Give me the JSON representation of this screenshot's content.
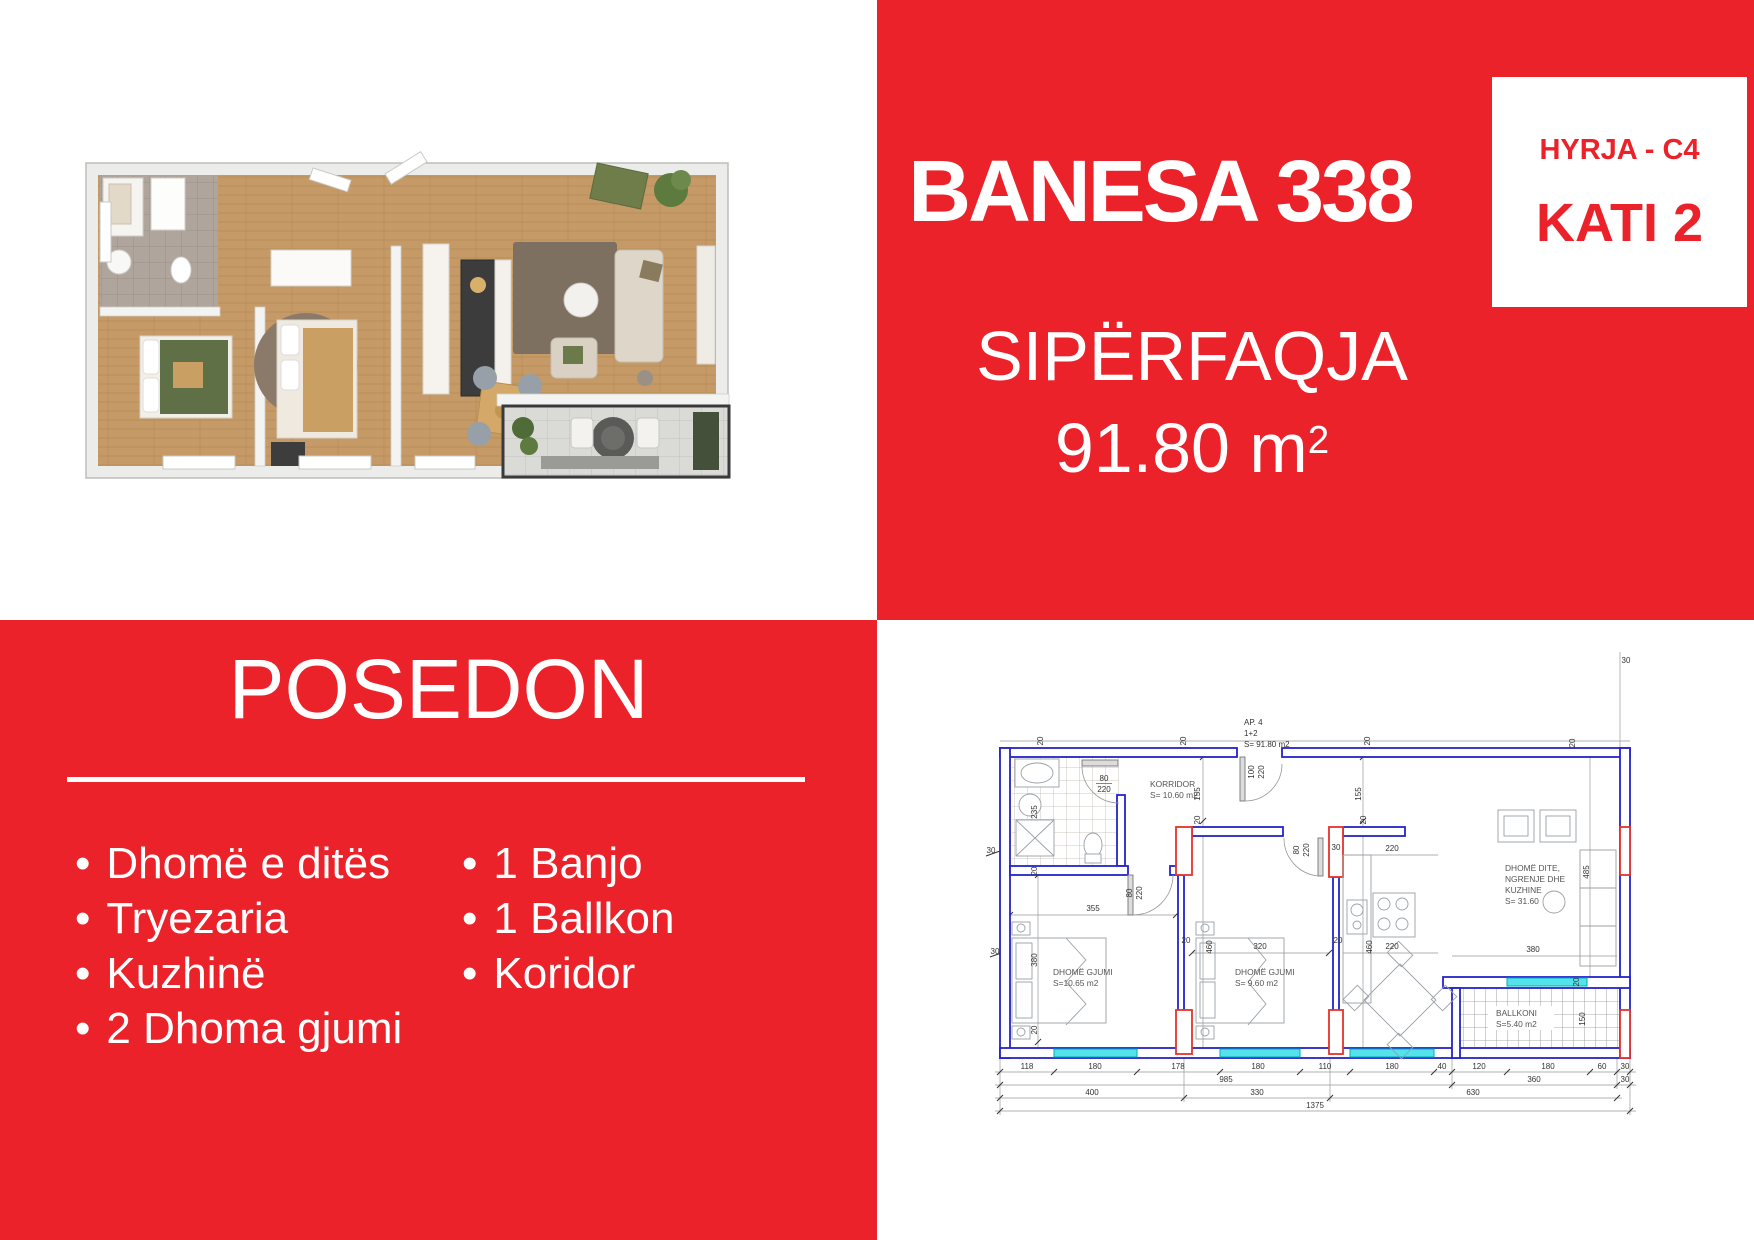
{
  "colors": {
    "brand_red": "#EB222A",
    "plan_wall_blue": "#2323CE",
    "plan_accent_red": "#E53228",
    "plan_window_cyan": "#55E2EA"
  },
  "top_right": {
    "title": "BANESA 338",
    "entry_label": "HYRJA - C4",
    "floor_label": "KATI 2",
    "area_heading": "SIPËRFAQJA",
    "area_value": "91.80 m",
    "area_sup": "2"
  },
  "posedon": {
    "title": "POSEDON",
    "left_items": [
      "Dhomë e ditës",
      "Tryezaria",
      "Kuzhinë",
      "2 Dhoma gjumi"
    ],
    "right_items": [
      "1 Banjo",
      "1 Ballkon",
      "Koridor"
    ]
  },
  "plan": {
    "unit_label": [
      "AP. 4",
      "1+2",
      "S= 91.80 m2"
    ],
    "rooms": {
      "korridor": [
        "KORRIDOR",
        "S= 10.60 m2"
      ],
      "gjumi1": [
        "DHOMË GJUMI",
        "S=10.65 m2"
      ],
      "gjumi2": [
        "DHOMË GJUMI",
        "S= 9.60 m2"
      ],
      "dite": [
        "DHOMË DITE,",
        "NGRENJE DHE",
        "KUZHINE",
        "S= 31.60"
      ],
      "ballkoni": [
        "BALLKONI",
        "S=5.40 m2"
      ]
    },
    "door80": [
      "80",
      "220"
    ],
    "door100": [
      "100",
      "220"
    ],
    "dims": {
      "bottom1": [
        "118",
        "180",
        "178",
        "180",
        "110",
        "180",
        "40",
        "120",
        "180",
        "60",
        "30"
      ],
      "bottom2": [
        "985",
        "360",
        "30"
      ],
      "bottom3": [
        "400",
        "330",
        "630"
      ],
      "bottom4": [
        "1375"
      ],
      "left": [
        "30",
        "235",
        "20",
        "30",
        "380",
        "20"
      ],
      "top": [
        "20",
        "20",
        "20",
        "20",
        "30"
      ],
      "inner": [
        "155",
        "155",
        "20",
        "20",
        "355",
        "320",
        "460",
        "460",
        "220",
        "220",
        "380",
        "20",
        "20",
        "30",
        "20"
      ],
      "right": [
        "485",
        "150"
      ]
    }
  }
}
